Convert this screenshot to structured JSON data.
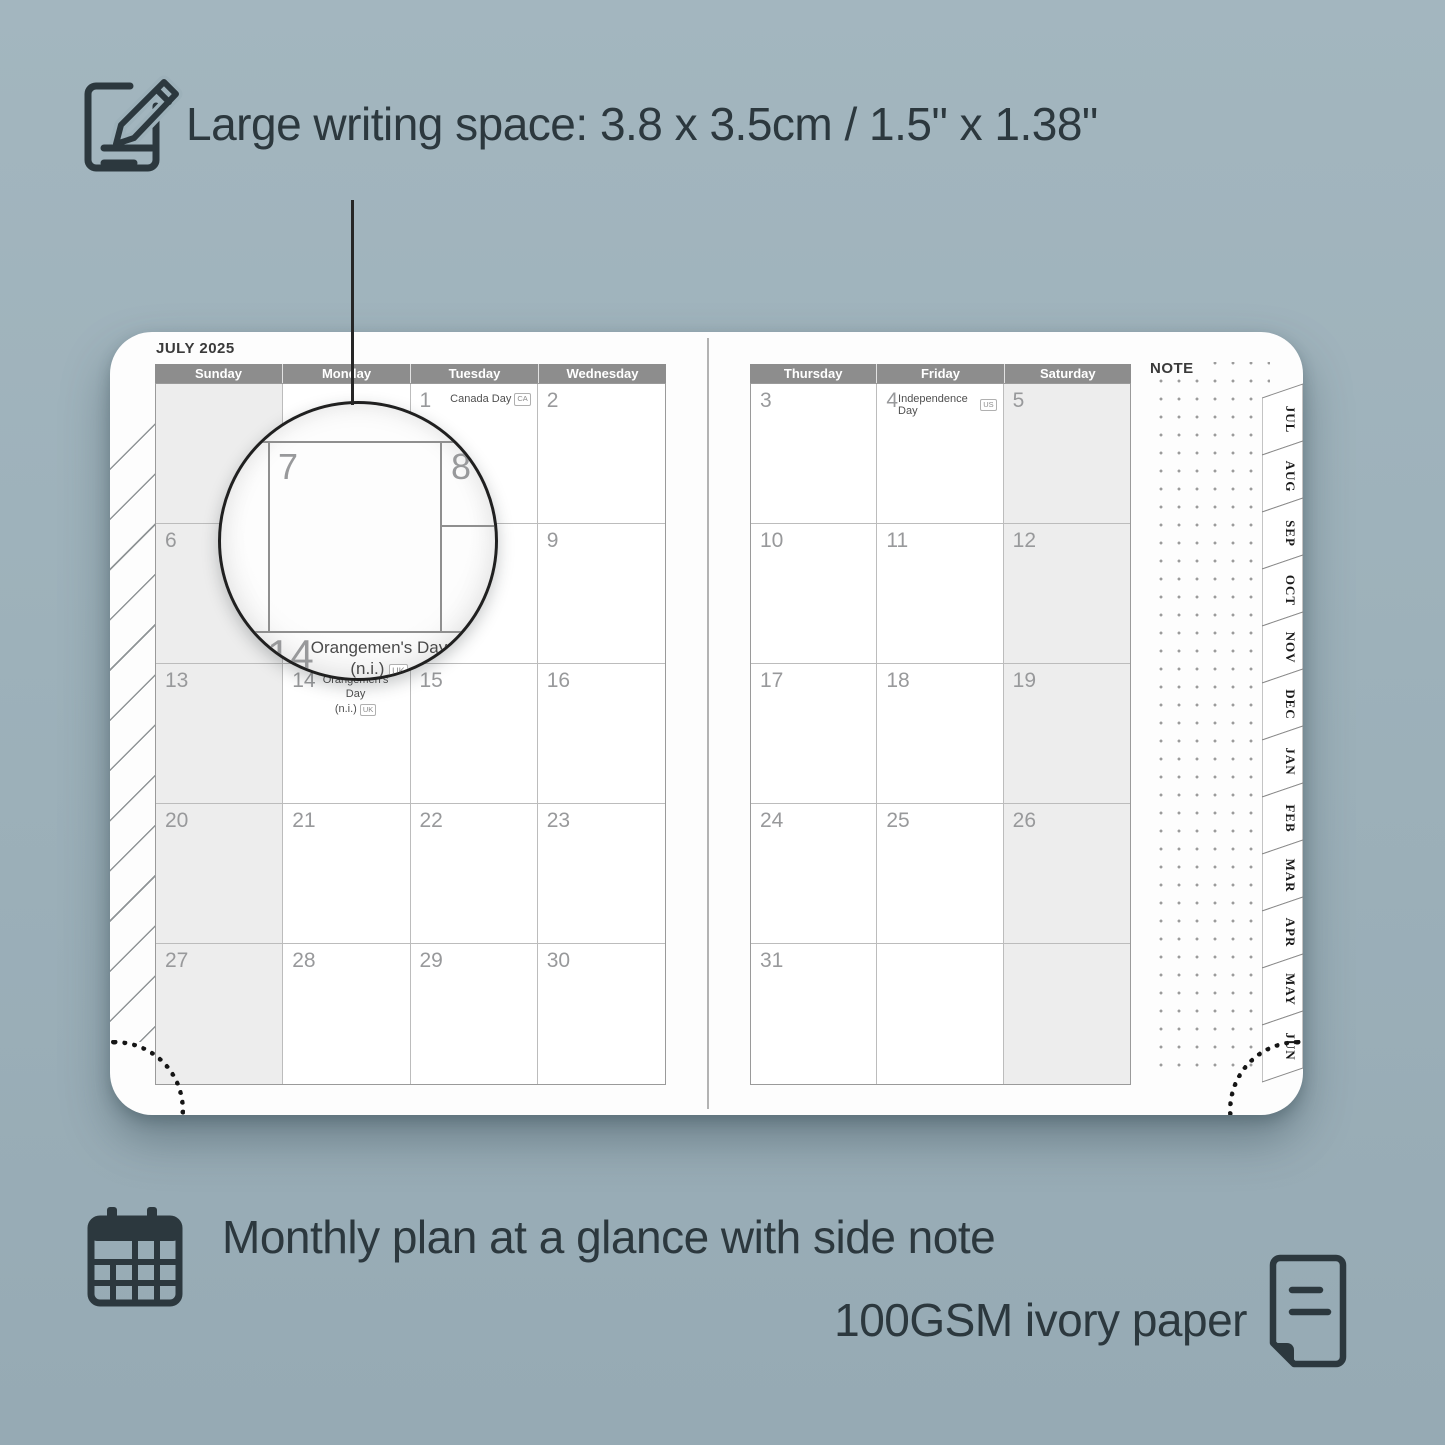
{
  "colors": {
    "background": "#9db1ba",
    "ink": "#2c383e",
    "header_bar": "#8d8d8d",
    "shaded_cell": "#ededed",
    "paper": "#fdfdfd"
  },
  "top_feature": {
    "heading": "Large writing space: 3.8 x 3.5cm / 1.5\" x 1.38\""
  },
  "bottom_features": {
    "line1": "Monthly plan at a glance with side note",
    "line2": "100GSM ivory paper"
  },
  "planner": {
    "month_title": "JULY 2025",
    "note_label": "NOTE",
    "day_headers_left": [
      "Sunday",
      "Monday",
      "Tuesday",
      "Wednesday"
    ],
    "day_headers_right": [
      "Thursday",
      "Friday",
      "Saturday"
    ],
    "tabs": [
      "JUL",
      "AUG",
      "SEP",
      "OCT",
      "NOV",
      "DEC",
      "JAN",
      "FEB",
      "MAR",
      "APR",
      "MAY",
      "JUN"
    ],
    "left_rows": [
      [
        "",
        "",
        "1",
        "2"
      ],
      [
        "6",
        "7",
        "8",
        "9"
      ],
      [
        "13",
        "14",
        "15",
        "16"
      ],
      [
        "20",
        "21",
        "22",
        "23"
      ],
      [
        "27",
        "28",
        "29",
        "30"
      ]
    ],
    "right_rows": [
      [
        "3",
        "4",
        "5"
      ],
      [
        "10",
        "11",
        "12"
      ],
      [
        "17",
        "18",
        "19"
      ],
      [
        "24",
        "25",
        "26"
      ],
      [
        "31",
        "",
        ""
      ]
    ],
    "holidays": {
      "canada": {
        "name": "Canada Day",
        "badge": "CA"
      },
      "independence": {
        "name": "Independence Day",
        "badge": "US"
      },
      "orangemen": {
        "line1": "Orangemen's Day",
        "line2": "(n.i.)",
        "badge": "UK"
      }
    }
  },
  "magnifier": {
    "top_left_day": "7",
    "top_right_day": "8",
    "bottom_day": "14",
    "holiday_line1": "Orangemen's Day",
    "holiday_line2": "(n.i.)",
    "badge": "UK"
  }
}
